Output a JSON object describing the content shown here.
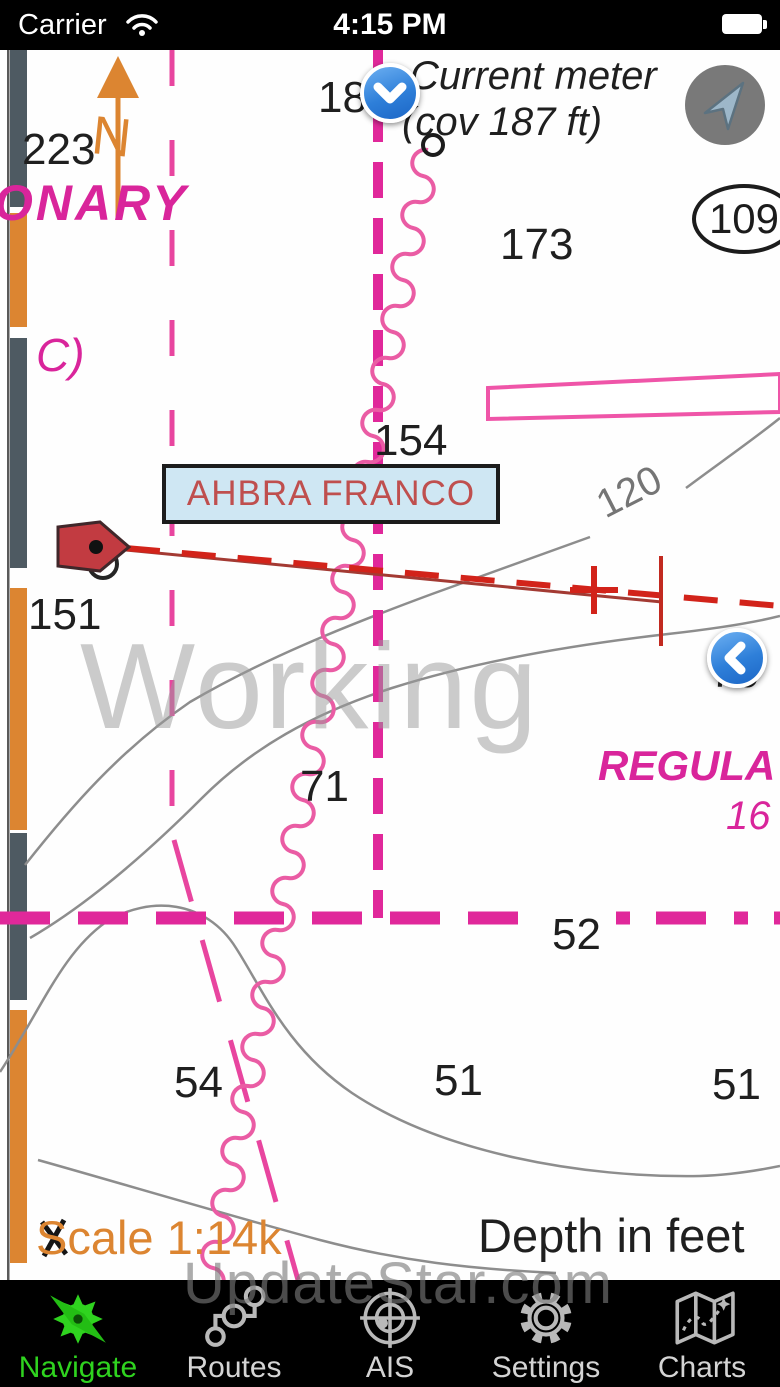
{
  "status_bar": {
    "carrier": "Carrier",
    "time": "4:15 PM",
    "battery_state": "full"
  },
  "map": {
    "watermark": "Working",
    "brand_watermark": "UpdateStar.com",
    "scale_text": "Scale 1:14k",
    "depth_unit_text": "Depth in feet",
    "vessel_name": "AHBRA FRANCO",
    "annotations": {
      "north_arrow_label": "N",
      "bearing_number": "223",
      "cautionary_text_partial": "ONARY",
      "area_designator": "C)",
      "partial_number_top": "18",
      "current_meter_label": "Current meter",
      "current_meter_coverage": "(cov 187 ft)",
      "circled_number": "109",
      "contour_label": "120",
      "regulated_text_partial": "REGULA",
      "regulated_number_partial": "16"
    },
    "depth_soundings": [
      {
        "v": "173",
        "x": 500,
        "y": 170
      },
      {
        "v": "154",
        "x": 374,
        "y": 366
      },
      {
        "v": "151",
        "x": 28,
        "y": 540
      },
      {
        "v": "76",
        "x": 710,
        "y": 598
      },
      {
        "v": "71",
        "x": 300,
        "y": 712
      },
      {
        "v": "52",
        "x": 552,
        "y": 860
      },
      {
        "v": "54",
        "x": 174,
        "y": 1008
      },
      {
        "v": "51",
        "x": 434,
        "y": 1006
      },
      {
        "v": "51",
        "x": 712,
        "y": 1010
      }
    ],
    "colors": {
      "magenta": "#e0289a",
      "orange": "#dc8531",
      "track_red": "#d2231a",
      "vessel_red": "#c23b41",
      "contour_gray": "#8d8d8d",
      "vessel_label_bg": "#cfe7f3",
      "vessel_label_text": "#bf4f4e"
    }
  },
  "tab_bar": {
    "active_color": "#2fd31f",
    "items": [
      {
        "label": "Navigate",
        "icon": "compass-icon",
        "active": true
      },
      {
        "label": "Routes",
        "icon": "route-icon",
        "active": false
      },
      {
        "label": "AIS",
        "icon": "radar-icon",
        "active": false
      },
      {
        "label": "Settings",
        "icon": "gear-icon",
        "active": false
      },
      {
        "label": "Charts",
        "icon": "map-icon",
        "active": false
      }
    ]
  }
}
